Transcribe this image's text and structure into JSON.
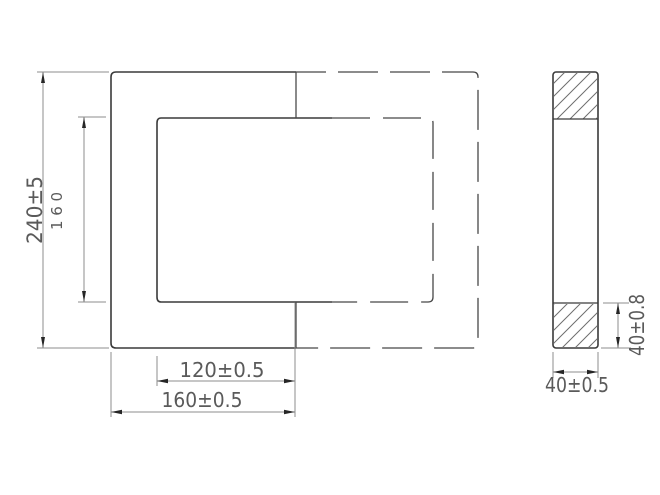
{
  "drawing_type": "engineering-drawing",
  "colors": {
    "background": "#ffffff",
    "outline": "#3a3a3a",
    "hidden_line": "#474747",
    "dimension_line": "#8e8e8e",
    "dimension_text": "#5a5a5a",
    "arrow": "#262626",
    "hatch_line": "#6e6e6e"
  },
  "front_view": {
    "description": "rectangular frame, front half solid outline, rear/mating half hidden dashed outline",
    "dimensions": {
      "overall_height": "240±5",
      "window_height": "160",
      "inner_width": "120±0.5",
      "outer_width": "160±0.5"
    }
  },
  "side_view": {
    "description": "cross-section with hatched top and bottom limb areas",
    "dimensions": {
      "end_section_height": "40±0.8",
      "thickness": "40±0.5"
    }
  }
}
